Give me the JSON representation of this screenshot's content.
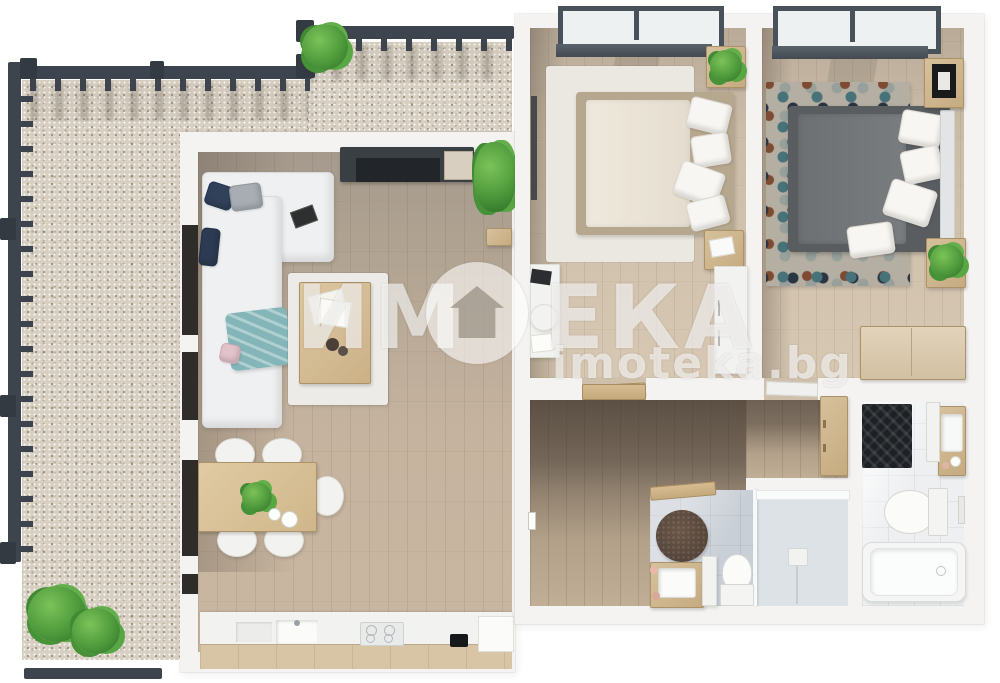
{
  "watermark": {
    "brand_full": "ИМОТЕКА",
    "brand_prefix": "ИМ",
    "brand_suffix": "ЕКА",
    "domain": "imoteka.bg",
    "logo_icon": "house-in-circle-icon"
  },
  "colors": {
    "wall": "#f4f3f1",
    "railing": "#3d444d",
    "gravel": "#d7cfc1",
    "wood_living": "#c3b19c",
    "wood_bedroom": "#d3c4b0",
    "wood_hall": "#b7a58d",
    "furniture_wood": "#cdb58f",
    "sofa": "#eff0f1",
    "duvet_light": "#e9e3d6",
    "duvet_dark": "#75797c",
    "rug_light": "#ebe8e1",
    "bath_tile": "#c9cfd6",
    "marble": "#edeff0",
    "plant": "#4e9a3c",
    "blanket_teal": "#84b6b9",
    "watermark": "rgba(255,255,255,0.62)"
  }
}
